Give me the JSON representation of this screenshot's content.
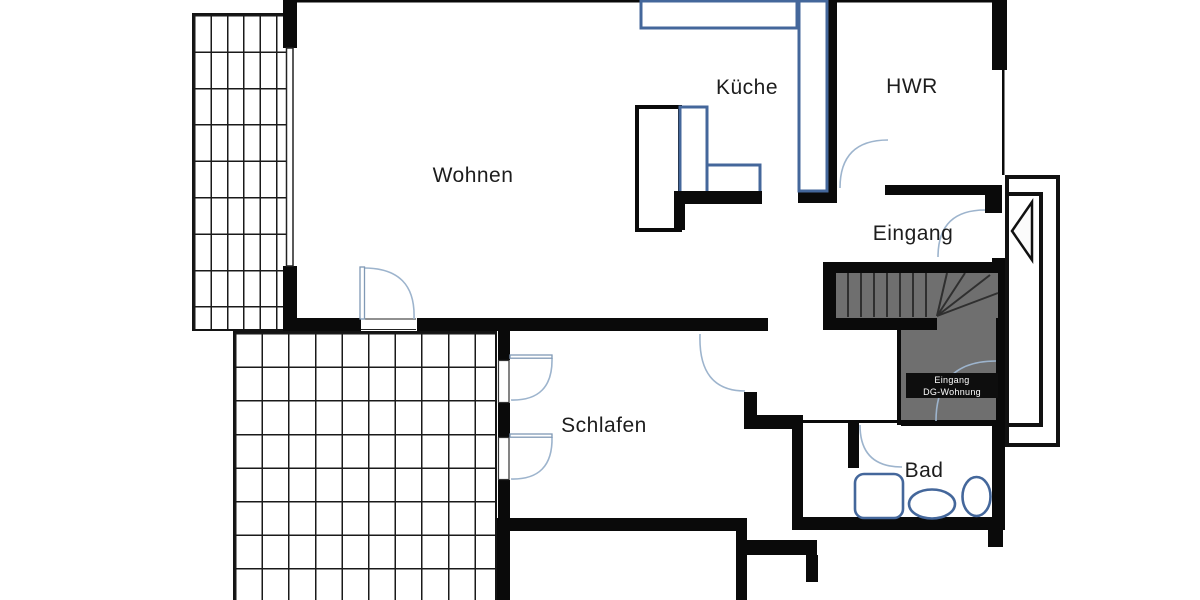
{
  "document": {
    "type": "floor-plan",
    "language": "de"
  },
  "rooms": {
    "wohnen": "Wohnen",
    "kueche": "Küche",
    "hwr": "HWR",
    "eingang": "Eingang",
    "schlafen": "Schlafen",
    "bad": "Bad"
  },
  "stair_entrance_label": {
    "line1": "Eingang",
    "line2": "DG-Wohnung"
  },
  "elements": {
    "staircase": "staircase with winder steps to upper-floor apartment",
    "entrance_arrow": "entrance direction arrow at front door",
    "bath_fixtures": [
      "shower",
      "toilet",
      "washbasin"
    ],
    "kitchen_fixtures": [
      "counter-top-run",
      "counter-right-run",
      "island-unit"
    ],
    "outdoor": [
      "balcony-hatch-top-left",
      "terrace-hatch-bottom-left"
    ]
  },
  "colors": {
    "wall": "#0a0a0a",
    "fixture_blue": "#44679b",
    "door_arc": "#9db4cd",
    "door_leaf": "#8099b5",
    "stair_gray": "#6f6f6f",
    "stair_step_line": "#2f2f2f",
    "label_box_bg": "#0e0e0e",
    "label_box_text": "#ffffff",
    "room_text": "#1d1d1d",
    "background": "#ffffff"
  }
}
